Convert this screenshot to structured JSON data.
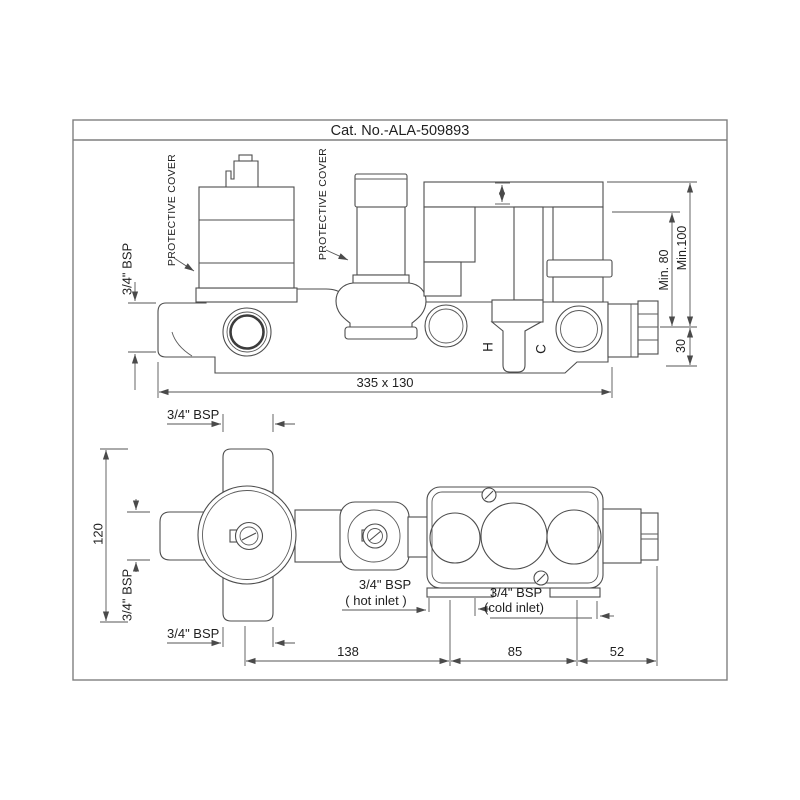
{
  "title": "Cat. No.-ALA-509893",
  "colors": {
    "background": "#ffffff",
    "line": "#4d4d4d",
    "dimension": "#555555",
    "frame_border": "#7f7f7f",
    "text": "#1f1f1f"
  },
  "top_view": {
    "protective_cover_label_1": "PROTECTIVE COVER",
    "protective_cover_label_2": "PROTECTIVE COVER",
    "bsp_inlet_label": "3/4\" BSP",
    "port_hot_label": "H",
    "port_cold_label": "C",
    "dims": {
      "min_depth_inner": "Min. 80",
      "min_depth_outer": "Min.100",
      "outlet_depth": "30",
      "overall": "335 x 130"
    }
  },
  "bottom_view": {
    "bsp_top_label": "3/4\" BSP",
    "bsp_left_label": "3/4\" BSP",
    "bsp_bottom_label": "3/4\" BSP",
    "hot_inlet_bsp": "3/4\" BSP",
    "hot_inlet_caption": "( hot inlet )",
    "cold_inlet_bsp": "3/4\" BSP",
    "cold_inlet_caption": "(cold inlet)",
    "dims": {
      "height": "120",
      "center_to_hot": "138",
      "hot_to_cold": "85",
      "cold_to_outlet": "52"
    }
  }
}
